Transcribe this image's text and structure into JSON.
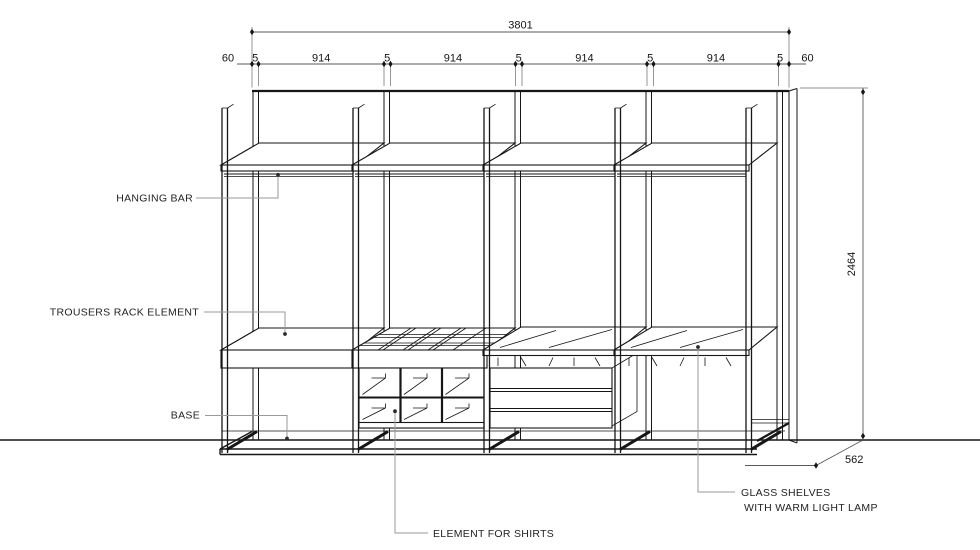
{
  "drawing": {
    "type": "wardrobe-elevation-technical-drawing",
    "units": "mm"
  },
  "dimensions": {
    "total_width": "3801",
    "segments": [
      "60",
      "5",
      "914",
      "5",
      "914",
      "5",
      "914",
      "5",
      "914",
      "5",
      "60"
    ],
    "height": "2464",
    "depth": "562"
  },
  "labels": {
    "hanging_bar": "HANGING BAR",
    "trousers_rack": "TROUSERS RACK ELEMENT",
    "base": "BASE",
    "element_for_shirts": "ELEMENT FOR SHIRTS",
    "glass_shelves_line1": "GLASS SHELVES",
    "glass_shelves_line2": "WITH WARM LIGHT LAMP"
  },
  "colors": {
    "line": "#161616",
    "leader": "#9a9a9a",
    "background": "#ffffff"
  }
}
